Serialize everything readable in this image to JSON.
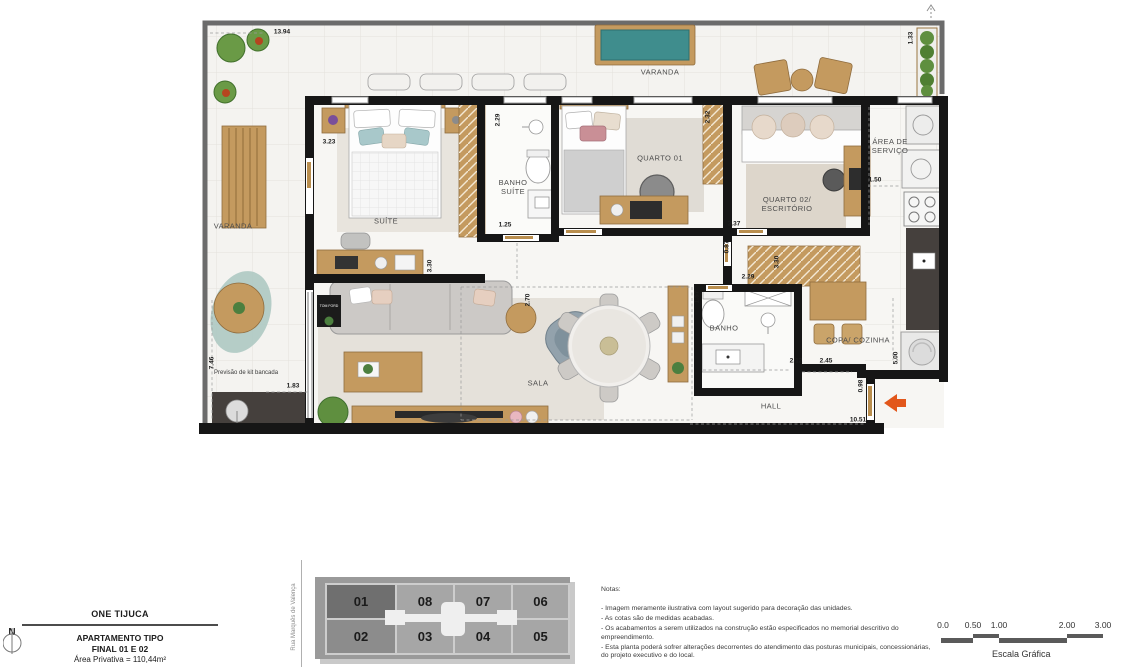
{
  "plan": {
    "rooms": {
      "varanda_left": "VARANDA",
      "varanda_top": "VARANDA",
      "suite": "SUÍTE",
      "banho_suite": "BANHO SUÍTE",
      "quarto01": "QUARTO 01",
      "quarto02": "QUARTO 02/ ESCRITÓRIO",
      "area_servico": "ÁREA DE SERVIÇO",
      "sala": "SALA",
      "banho": "BANHO",
      "copa_cozinha": "COPA/ COZINHA",
      "hall": "HALL",
      "kit_bancada": "Previsão de kit bancada"
    },
    "dims": [
      "13.94",
      "3.23",
      "2.29",
      "2.32",
      "1.33",
      "1.50",
      "1.25",
      "3.37",
      "0.87",
      "2.29",
      "3.30",
      "3.30",
      "2.70",
      "1.57",
      "2.12",
      "2.45",
      "5.00",
      "0.98",
      "10.51",
      "7.46",
      "1.83"
    ],
    "decor": {
      "tom_ford": "TOM FORD"
    }
  },
  "title_block": {
    "north": "N",
    "project": "ONE TIJUCA",
    "type": "APARTAMENTO TIPO",
    "finals": "FINAL 01 E 02",
    "area": "Área Privativa = 110,44m²"
  },
  "key_plan": {
    "street": "Rua Marquês de Valença",
    "units_top": [
      "01",
      "08",
      "07",
      "06"
    ],
    "units_bottom": [
      "02",
      "03",
      "04",
      "05"
    ]
  },
  "notes": {
    "heading": "Notas:",
    "items": [
      "- Imagem meramente ilustrativa com layout sugerido para decoração das unidades.",
      "- As cotas são de medidas acabadas.",
      "- Os acabamentos a serem utilizados na construção estão especificados no memorial descritivo do empreendimento.",
      "- Esta planta poderá sofrer alterações  decorrentes  do atendimento das posturas municipais, concessionárias, do projeto executivo e do local."
    ]
  },
  "scale_bar": {
    "ticks": [
      "0.0",
      "0.50",
      "1.00",
      "2.00",
      "3.00"
    ],
    "label": "Escala Gráfica"
  },
  "colors": {
    "wall": "#161616",
    "wood": "#c49a5f",
    "wood_dark": "#8f6c3e",
    "pool": "#3f8d8d",
    "counter_dark": "#45403d",
    "arrow": "#e2571b",
    "keyplan_bg": "#9a9a9a",
    "keyplan_unit": "#a6a6a6",
    "keyplan_unit_highlight": "#6f6f6f"
  }
}
